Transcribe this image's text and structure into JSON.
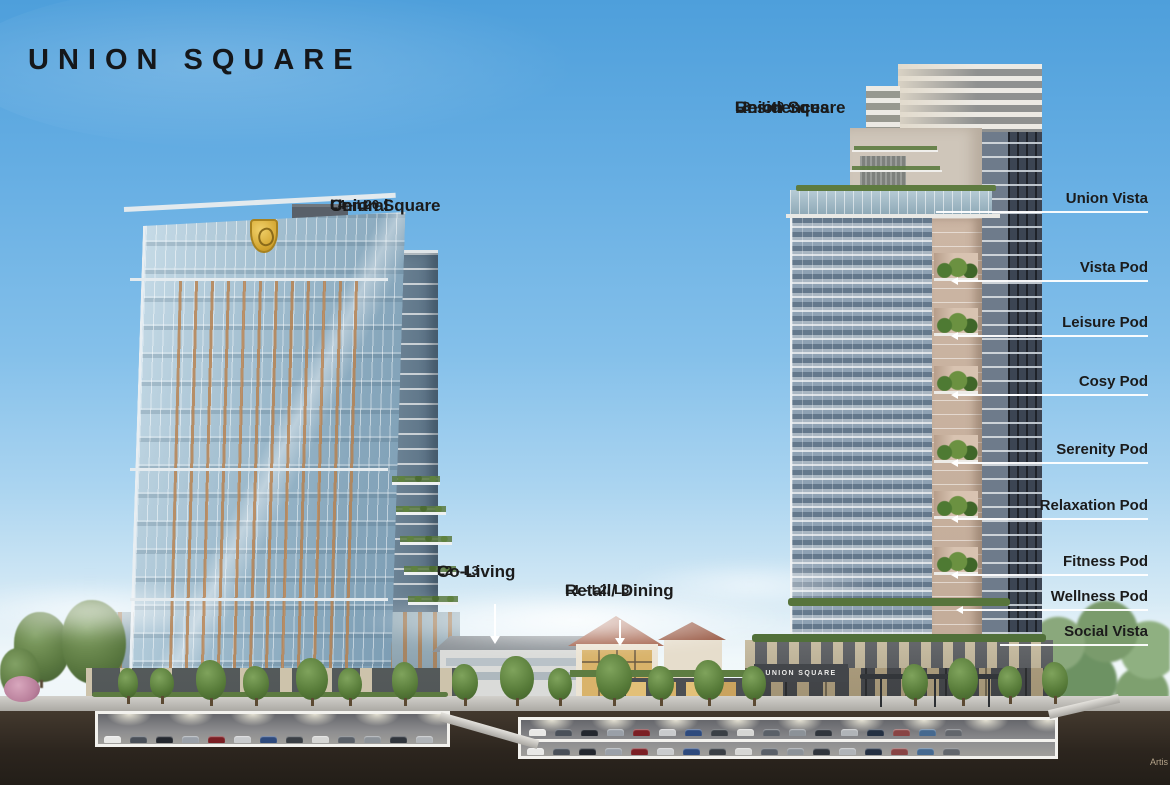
{
  "page": {
    "logo": "UNION SQUARE",
    "artist_note": "Artis"
  },
  "annotations": {
    "central": {
      "line1": "Union Square",
      "line2": "Central",
      "levels": "L4 - L20"
    },
    "residences": {
      "line1": "Union Square",
      "line2": "Residences",
      "levels": "L3 - L40"
    },
    "co_living": {
      "title": "Co-Living",
      "levels": "L2 - L3"
    },
    "retail_dining": {
      "title": "Retail/ Dining",
      "levels": "L1 - L2/ L3"
    }
  },
  "callouts": [
    {
      "label": "Union Vista"
    },
    {
      "label": "Vista Pod"
    },
    {
      "label": "Leisure Pod"
    },
    {
      "label": "Cosy Pod"
    },
    {
      "label": "Serenity Pod"
    },
    {
      "label": "Relaxation Pod"
    },
    {
      "label": "Fitness Pod"
    },
    {
      "label": "Wellness Pod"
    },
    {
      "label": "Social Vista"
    }
  ],
  "signage": {
    "podium_sign": "UNION SQUARE"
  },
  "colors": {
    "sky_top": "#4e9fdb",
    "sky_horizon": "#f2f7f7",
    "label_text": "#1b1b1b",
    "leader_line": "#ffffff",
    "amber_fin": "#b8804c",
    "gold_logo": "#d3a52f",
    "greenery": "#5a7a3f",
    "terracotta_roof": "#a05a42",
    "soil": "#2c251e"
  },
  "parking": {
    "left_count": 13,
    "upper_count": 17,
    "lower_count": 17,
    "car_colors": [
      "#e8e8e6",
      "#4a5059",
      "#23272e",
      "#9aa0a8",
      "#7b1f24",
      "#c9cbcd",
      "#2e4a7d",
      "#3a3f45",
      "#d6d6d4",
      "#5a6068",
      "#8c9298",
      "#30353c",
      "#b0b4b8",
      "#243042",
      "#884444",
      "#46698f",
      "#62666c"
    ]
  }
}
